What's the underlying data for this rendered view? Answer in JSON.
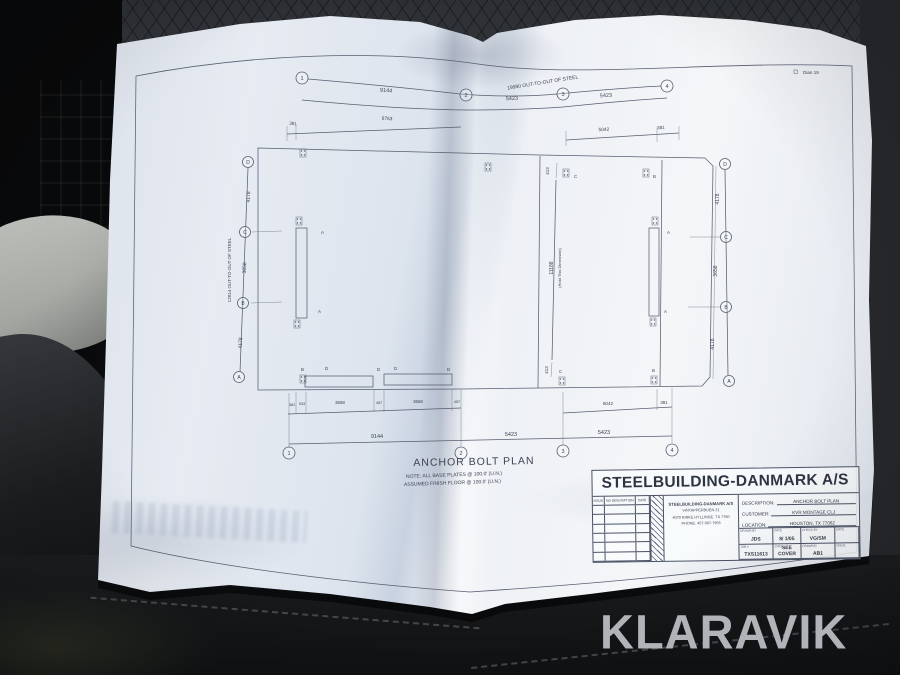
{
  "photo": {
    "watermark": "KLARAVIK",
    "corner_note": "Dian 19"
  },
  "plan": {
    "title": "ANCHOR BOLT PLAN",
    "notes": [
      "NOTE: ALL BASE PLATES @ 100.0' (U.N.)",
      "ASSUMED FINISH FLOOR @ 100.0' (U.N.)"
    ],
    "grid_cols": [
      "1",
      "2",
      "3",
      "4"
    ],
    "grid_rows": [
      "D",
      "C",
      "B",
      "A"
    ],
    "top_total": "19990  OUT-TO-OUT OF STEEL",
    "top_dims": [
      "9144",
      "5423",
      "5423"
    ],
    "top_sub_dims": [
      "381",
      "8763",
      "5042",
      "381"
    ],
    "left_total": "12014 OUT-TO-OUT OF STEEL",
    "side_dims": [
      "4178",
      "3658",
      "4178"
    ],
    "center_dims": [
      "413",
      "11188",
      "413"
    ],
    "center_note": "(Hold This Dimension)",
    "bottom_sub_dims": [
      "381",
      "533",
      "3658",
      "457",
      "3658",
      "457"
    ],
    "bottom_mid_dims": [
      "5042",
      "381"
    ],
    "bottom_totals": [
      "9144",
      "5423",
      "5423"
    ],
    "marks": {
      "a": "A",
      "b": "B",
      "c": "C",
      "d": "D"
    }
  },
  "titleblock": {
    "company": "STEELBUILDING-DANMARK A/S",
    "rev_headers": [
      "ISSUE",
      "NO  DESCRIPTION",
      "DATE"
    ],
    "address": {
      "name": "STEELBUILDING-DANMARK A/S",
      "street": "VINTAPPERBUEN 21",
      "city": "4070 KIRKE HYLLINGE, TX 7760",
      "phone": "PHONE: 457-007-7955"
    },
    "fields": [
      {
        "label": "DESCRIPTION:",
        "value": "ANCHOR BOLT PLAN"
      },
      {
        "label": "CUSTOMER:",
        "value": "KVR MONTAGE CLJ"
      },
      {
        "label": "LOCATION:",
        "value": "HOUSTON, TX 77062"
      }
    ],
    "cells": [
      {
        "label": "DRAWN BY",
        "value": "JDS"
      },
      {
        "label": "DATE",
        "value": "8/ 1/05"
      },
      {
        "label": "CHECK BY",
        "value": "VG/SM"
      },
      {
        "label": "DATE",
        "value": ""
      },
      {
        "label": "JOB #",
        "value": "TXS11613"
      },
      {
        "label": "CHKD",
        "value": "SEE COVER"
      },
      {
        "label": "DRAWING",
        "value": "AB1"
      },
      {
        "label": "ISSUE",
        "value": ""
      }
    ]
  }
}
